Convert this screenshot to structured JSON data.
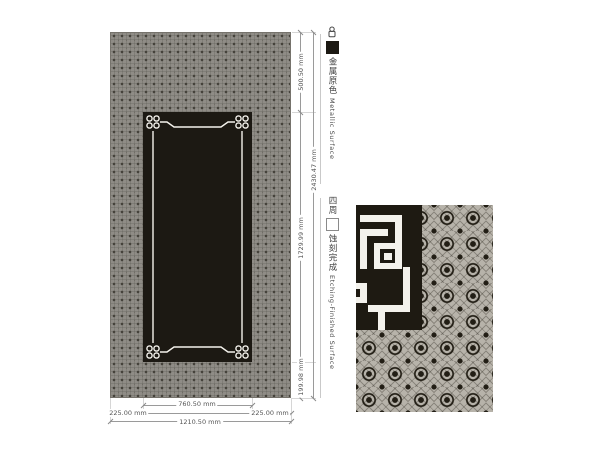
{
  "drawing": {
    "panel_description": "etched decorative metal panel elevation",
    "colors": {
      "pattern_base": "#8f8c86",
      "pattern_dot": "#45423b",
      "etched_black": "#1c1913",
      "frame_white": "#f4f2ec",
      "detail_base": "#b7b3aa",
      "dim_line": "#9a9a9a",
      "dim_text": "#555555"
    }
  },
  "labels": {
    "metallic": {
      "cn": "金属原色",
      "en": "Metallic Surface",
      "swatch": "black-square-swatch"
    },
    "etching": {
      "prefix_cn": "四周",
      "cn": "蚀刻完成",
      "en": "Etching-Finished Surface",
      "swatch": "white-square-swatch"
    }
  },
  "dimensions": {
    "width_inner": "760.50 mm",
    "width_left": "225.00 mm",
    "width_right": "225.00 mm",
    "width_total": "1210.50 mm",
    "height_top": "500.50 mm",
    "height_total": "2430.47 mm",
    "height_inner": "1729.99 mm",
    "height_bottom": "199.98 mm",
    "unit": "mm"
  },
  "icons": {
    "marker": "ornament-marker-icon",
    "black_swatch": "metallic-surface-swatch-icon",
    "white_swatch": "etched-surface-swatch-icon"
  }
}
